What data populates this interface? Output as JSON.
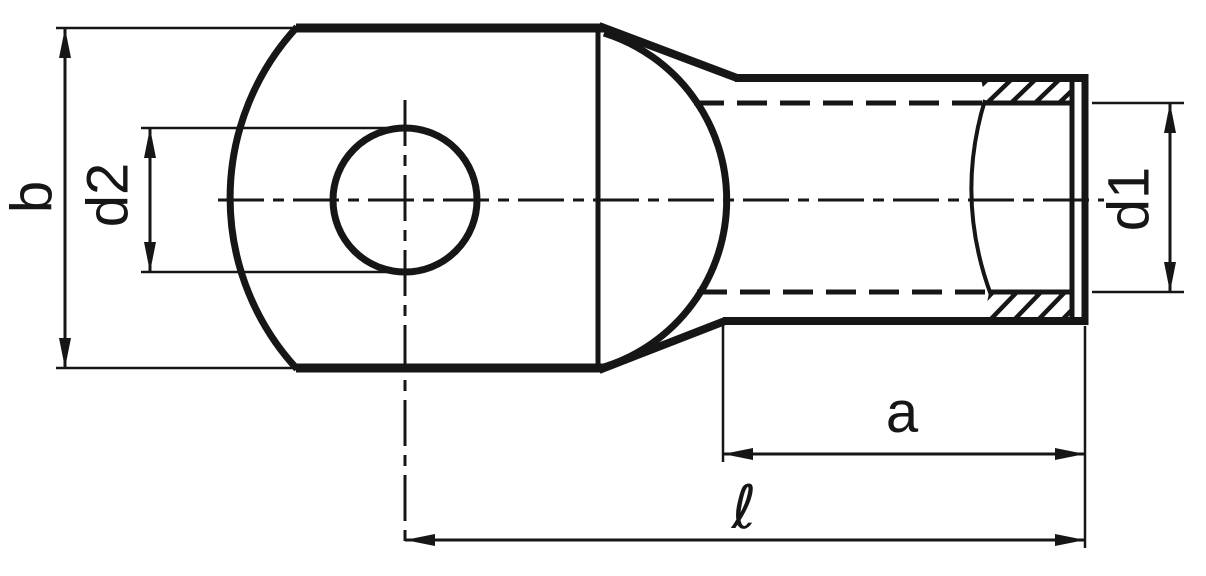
{
  "figure": {
    "background_color": "#ffffff",
    "line_color": "#161616",
    "description": "Technical dimension drawing of a tube cable lug (ring terminal), side view with broken-out section at barrel end"
  },
  "labels": {
    "palm_width": "b",
    "hole_diameter": "d2",
    "bore_diameter": "d1",
    "barrel_length": "a",
    "total_length": "ℓ"
  }
}
